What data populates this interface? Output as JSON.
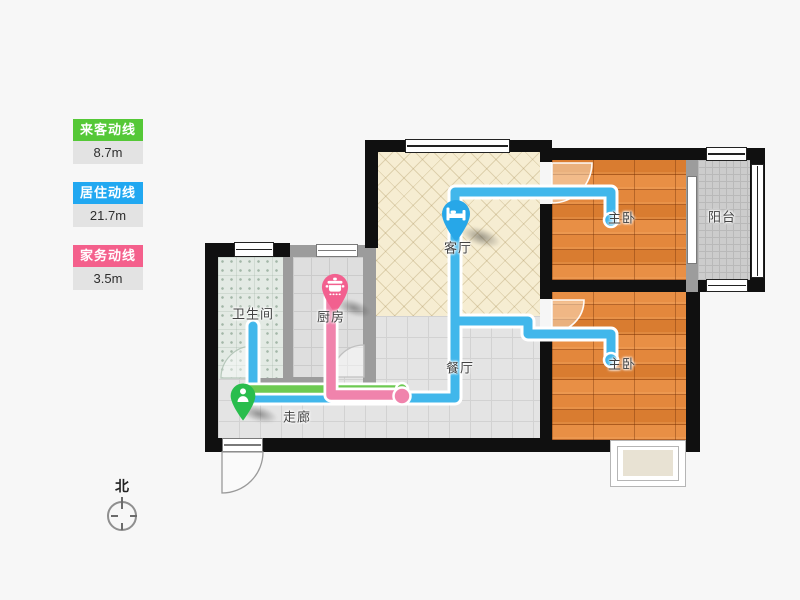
{
  "legend": {
    "items": [
      {
        "label": "来客动线",
        "value": "8.7m",
        "color": "#55c837"
      },
      {
        "label": "居住动线",
        "value": "21.7m",
        "color": "#21a8f1"
      },
      {
        "label": "家务动线",
        "value": "3.5m",
        "color": "#f4608c"
      }
    ]
  },
  "compass": {
    "label": "北"
  },
  "plan": {
    "rooms": {
      "bathroom": "卫生间",
      "kitchen": "厨房",
      "living": "客厅",
      "dining": "餐厅",
      "corridor": "走廊",
      "bedroom1": "主卧",
      "bedroom2": "主卧",
      "balcony": "阳台"
    },
    "lines": {
      "visitor": {
        "color": "#6dca52"
      },
      "living": {
        "color": "#41b7eb"
      },
      "housework": {
        "color": "#f083ac"
      }
    },
    "markers": {
      "living": {
        "icon": "bed-icon",
        "color": "#27a7e8"
      },
      "kitchen": {
        "icon": "pot-icon",
        "color": "#f2608f"
      },
      "entrance": {
        "icon": "person-icon",
        "color": "#29bd4d"
      }
    }
  }
}
